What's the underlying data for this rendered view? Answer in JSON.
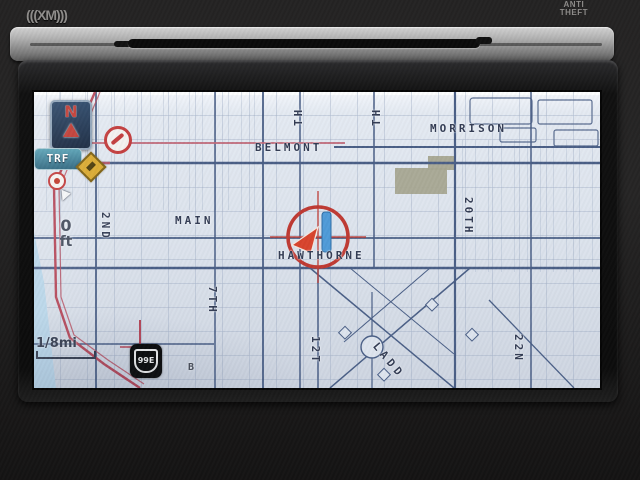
{
  "device": {
    "xm_logo": "(((XM)))",
    "anti_theft": [
      "ANTI",
      "THEFT"
    ]
  },
  "hud": {
    "compass_n": "N",
    "trf_label": "TRF",
    "distance_value": "0",
    "distance_unit": "ft",
    "scale_label": "1/8mi",
    "route_shield": "99E",
    "poi_marker": "B"
  },
  "map": {
    "streets": {
      "belmont": "BELMONT",
      "morrison": "MORRISON",
      "main": "MAIN",
      "hawthorne": "HAWTHORNE",
      "second": "2ND",
      "seventh": "7TH",
      "twelfth": "12T",
      "twentieth": "20TH",
      "twentysecond": "22N",
      "ladd": "LADD",
      "top_partial_1": "TH",
      "top_partial_2": "TH"
    },
    "colors": {
      "map_bg": "#dde4ee",
      "grid": "#96a5bf",
      "major_road": "#4a5f86",
      "route_red": "#b5485a",
      "marker_red": "#bf3a33",
      "water": "#b9d6ea",
      "block_olive": "#a6a691"
    }
  }
}
